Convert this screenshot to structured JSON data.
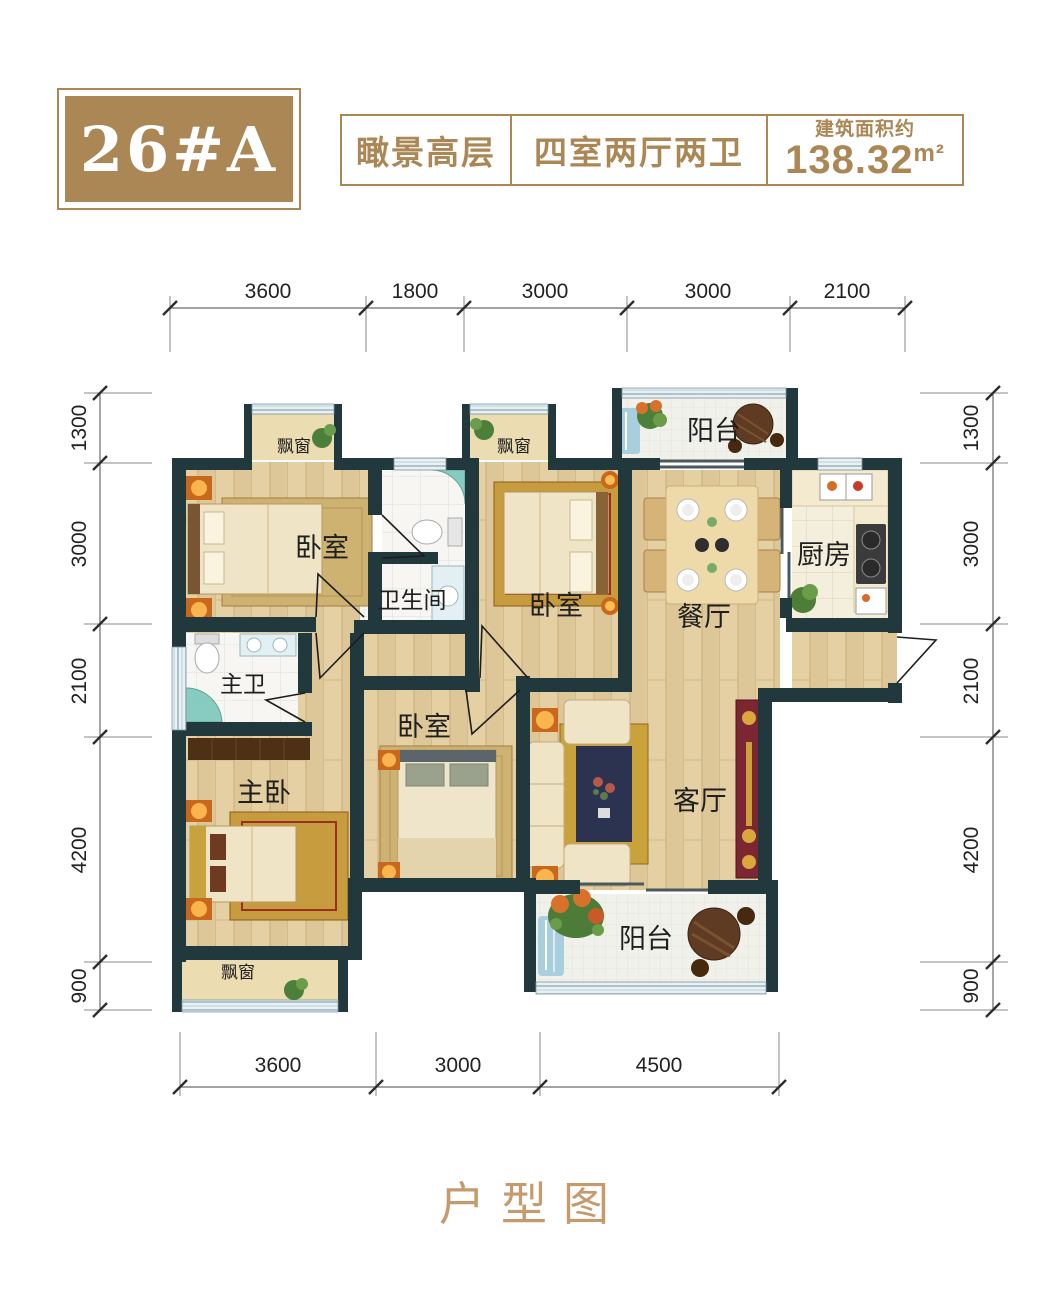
{
  "header": {
    "unit": "26#A",
    "feature": "瞰景高层",
    "layout": "四室两厅两卫",
    "area_label": "建筑面积约",
    "area_value": "138.32",
    "area_unit": "m²"
  },
  "dimensions": {
    "top": [
      "3600",
      "1800",
      "3000",
      "3000",
      "2100"
    ],
    "bottom": [
      "3600",
      "3000",
      "4500"
    ],
    "left": [
      "1300",
      "3000",
      "2100",
      "4200",
      "900"
    ],
    "right": [
      "1300",
      "3000",
      "2100",
      "4200",
      "900"
    ]
  },
  "rooms": {
    "bedroom1": "卧室",
    "bedroom2": "卧室",
    "bedroom3": "卧室",
    "master_bedroom": "主卧",
    "master_bath": "主卫",
    "bathroom": "卫生间",
    "kitchen": "厨房",
    "dining": "餐厅",
    "living": "客厅",
    "balcony_top": "阳台",
    "balcony_bottom": "阳台",
    "bay_window1": "飘窗",
    "bay_window2": "飘窗",
    "bay_window3": "飘窗"
  },
  "footer": {
    "caption": "户型图"
  },
  "colors": {
    "gold": "#ab8755",
    "wall": "#21383c",
    "wood_floor": "#dcc697",
    "footer_text": "#c59b6e"
  }
}
